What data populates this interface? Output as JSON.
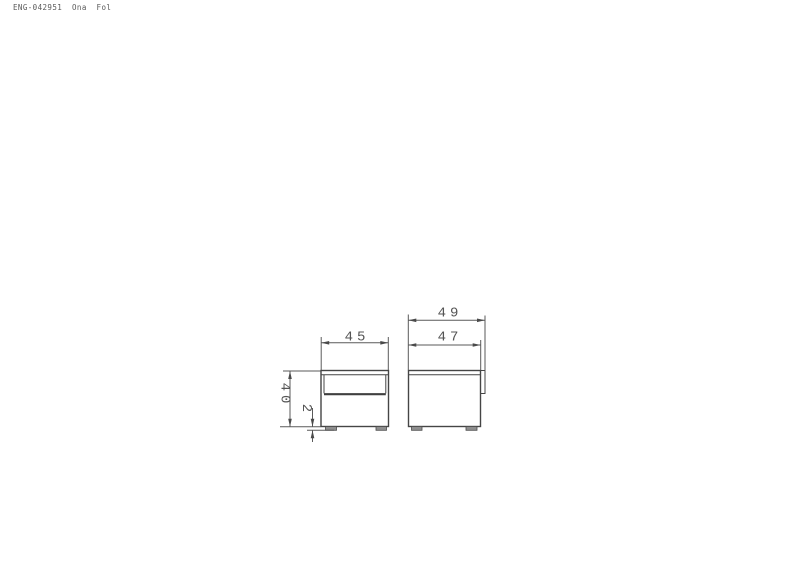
{
  "header": {
    "doc_code": "ENG-042951  Ona  Fol"
  },
  "drawing": {
    "title": "nightstand two-view dimensioned drawing",
    "views": [
      {
        "id": "front",
        "description": "front elevation with drawer and two feet"
      },
      {
        "id": "side",
        "description": "side elevation with protruding drawer front and two feet"
      }
    ],
    "dimensions": {
      "front_width": "45",
      "overall_height": "40",
      "foot_height": "2",
      "overall_depth": "49",
      "carcass_depth": "47"
    },
    "colors": {
      "background": "#ffffff",
      "object_line": "#454545",
      "dimension_line": "#5a5a5a",
      "label_text": "#555555",
      "foot_fill": "#8f8f8f"
    }
  }
}
